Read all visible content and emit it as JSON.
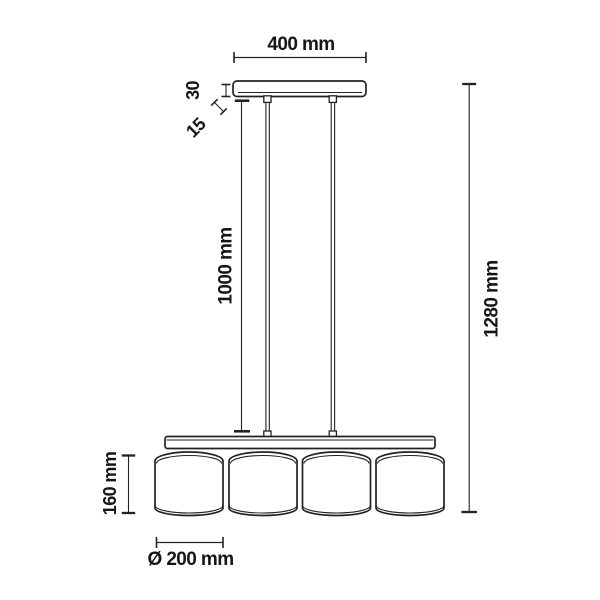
{
  "diagram": {
    "colors": {
      "line": "#222222",
      "background": "#ffffff",
      "text": "#161616"
    },
    "labels": {
      "canopy_width": "400 mm",
      "canopy_height": "30",
      "canopy_gap": "15",
      "cord_length": "1000 mm",
      "overall_height": "1280 mm",
      "shade_height": "160 mm",
      "shade_diameter": "Ø 200 mm"
    }
  }
}
